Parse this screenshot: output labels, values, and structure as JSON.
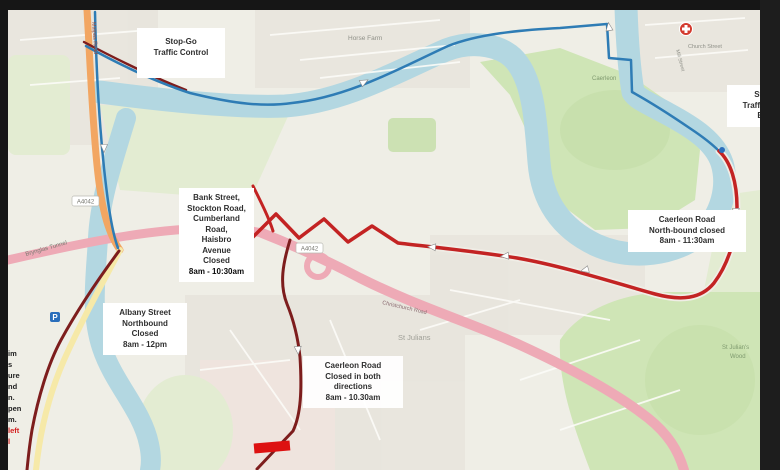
{
  "colors": {
    "land": "#efeee6",
    "residential": "#e7e4dc",
    "residential_pink": "#f0e2dd",
    "green": "#cfe5b6",
    "green_pale": "#e3ecd2",
    "green_dark": "#c3dda6",
    "water": "#b3d7e1",
    "road_orange": "#f2a662",
    "road_pink": "#eeaab6",
    "road_yellow": "#f6e9a8",
    "minor_road": "#fcfcf8",
    "route_blue": "#2e7cb5",
    "route_red": "#c32323",
    "route_maroon": "#7d1d1d",
    "barrier_red": "#dd1111",
    "marker_blue": "#2a6ebb",
    "marker_red": "#d33a2e",
    "letterbox": "#161616",
    "box_bg": "#ffffff",
    "box_text": "#2f2f2f",
    "alert_red": "#d42020"
  },
  "annotations": {
    "stop_go_left": {
      "lines": [
        "Stop-Go",
        "Traffic Control"
      ]
    },
    "bank_street": {
      "lines": [
        "Bank Street,",
        "Stockton Road,",
        "Cumberland",
        "Road,",
        "Haisbro",
        "Avenue",
        "Closed"
      ],
      "time": "8am - 10:30am"
    },
    "albany": {
      "lines": [
        "Albany Street",
        "Northbound",
        "Closed"
      ],
      "time": "8am - 12pm"
    },
    "caerleon_center": {
      "lines": [
        "Caerleon Road",
        "Closed in both",
        "directions"
      ],
      "time": "8am - 10.30am"
    },
    "caerleon_right": {
      "lines": [
        "Caerleon Road",
        "North-bound closed"
      ],
      "time": "8am - 11:30am"
    },
    "stop_go_bridge": {
      "lines": [
        "Stop-Go",
        "Traffic Control",
        "Bridge"
      ]
    },
    "left_clipped": {
      "lines": [
        "im",
        "s",
        "ure",
        "nd",
        "n.",
        "pen",
        "m."
      ],
      "red_lines": [
        "left",
        "l"
      ]
    }
  },
  "map_labels": {
    "horse_farm": "Horse Farm",
    "brynglas": "Brynglas Tunnel",
    "st_julians": "St Julians",
    "st_julians_wood_1": "St Julian's",
    "st_julians_wood_2": "Wood",
    "christchurch": "Christchurch Road",
    "church_street": "Church Street",
    "mill_street": "Mill Street",
    "caerleon": "Caerleon",
    "malpas_road": "Malpas Road",
    "badge_a4042": "A4042"
  },
  "markers": {
    "parking": "P"
  }
}
